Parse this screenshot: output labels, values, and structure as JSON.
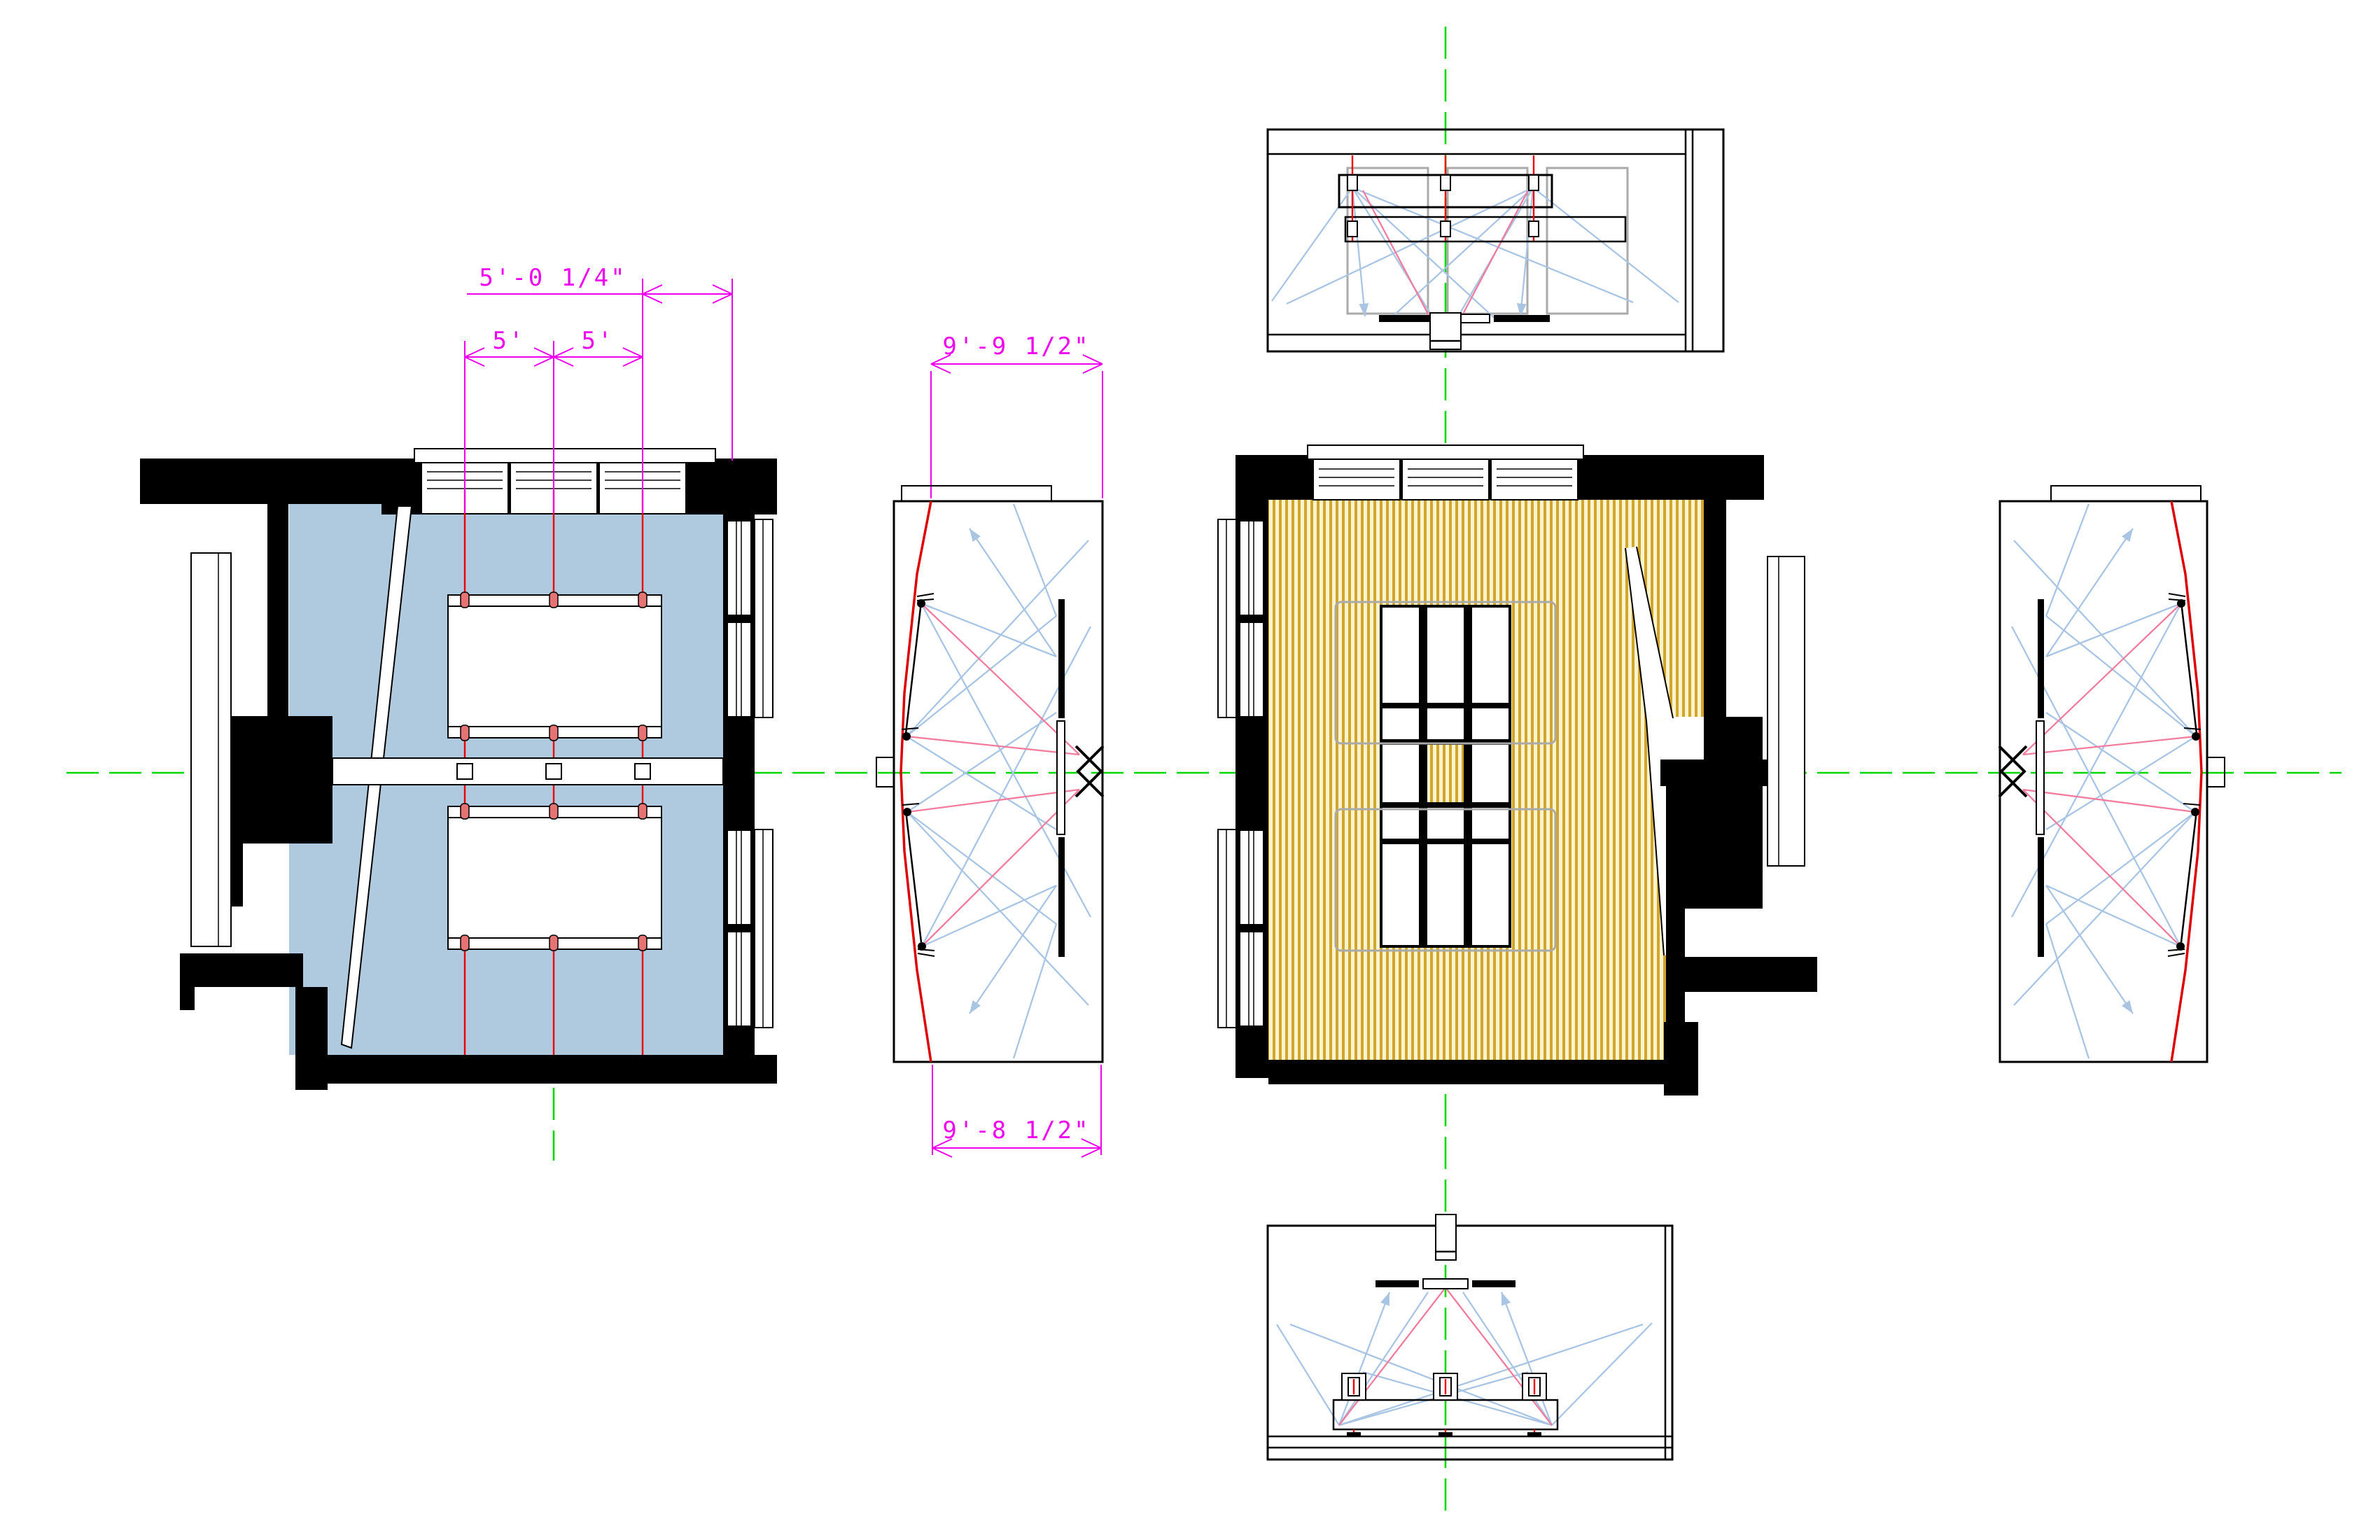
{
  "drawing": {
    "type": "cad-room-speaker-layout",
    "dimensions": {
      "plan_overall": "5'-0 1/4\"",
      "plan_bay_left": "5'",
      "plan_bay_right": "5'",
      "section_top_width": "9'-9 1/2\"",
      "section_bottom_width": "9'-8 1/2\""
    },
    "colors": {
      "wall": "#000000",
      "room_fill_plan_left": "#AFC9DE",
      "floor_hatch_gold": "#D2A62C",
      "floor_hatch_pale": "#FBF4CC",
      "centerline_green": "#00D800",
      "speaker_line_red": "#EE0000",
      "dimension_magenta": "#EE00EE",
      "sightline_blue": "#A9C5E3",
      "sightline_pink": "#F27C9E",
      "table_outline_gray": "#AAAAAA"
    }
  }
}
